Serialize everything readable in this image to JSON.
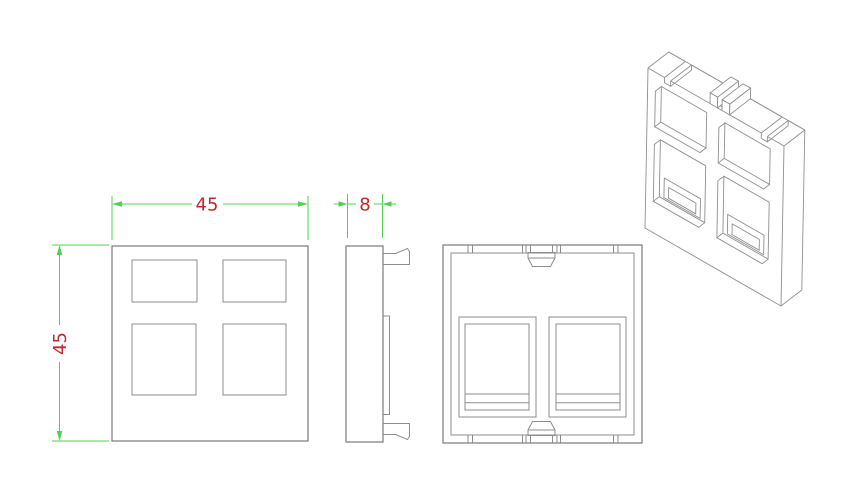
{
  "dimensions": {
    "front_width": "45",
    "front_height": "45",
    "side_depth": "8"
  },
  "colors": {
    "background": "#ffffff",
    "drawing_line": "#7a7a7a",
    "dimension_line": "#53d053",
    "dimension_text": "#c1272d"
  }
}
